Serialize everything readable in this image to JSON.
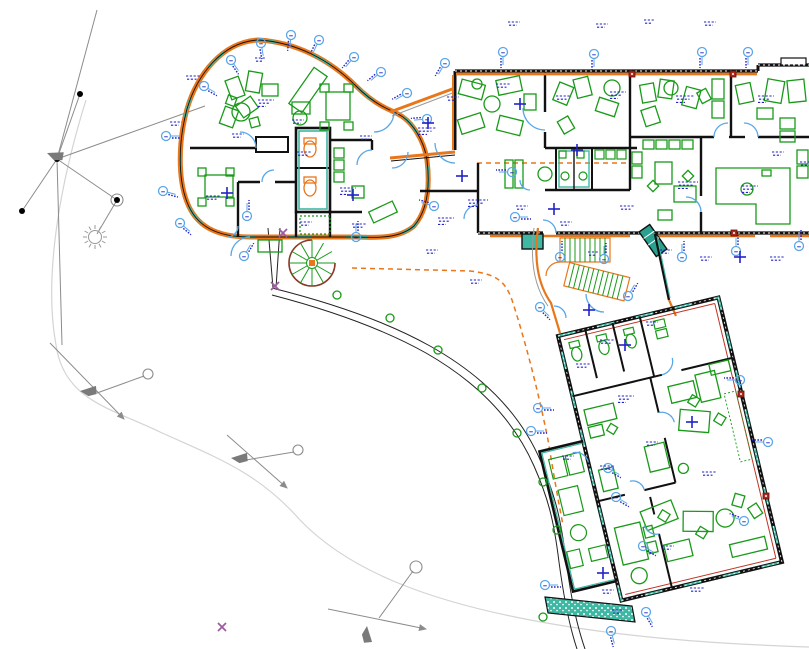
{
  "palette": {
    "wall_orange": "#E8761B",
    "wall_teal": "#3FB8A3",
    "wall_black": "#111111",
    "furniture_green": "#189A18",
    "annotation_blue": "#2323C8",
    "door_light_blue": "#5AA7E8",
    "site_gray": "#8C8C8C",
    "contour_light_gray": "#D4D4D4",
    "stair_brown": "#8B3A2A",
    "stripe_red": "#C23222",
    "marker_red": "#B3281E",
    "mark_magenta": "#A05AA0"
  },
  "annotations": {
    "tags": [
      [
        166,
        136,
        0
      ],
      [
        163,
        191,
        15
      ],
      [
        180,
        223,
        40
      ],
      [
        204,
        86,
        30
      ],
      [
        231,
        60,
        55
      ],
      [
        261,
        43,
        80
      ],
      [
        291,
        35,
        95
      ],
      [
        319,
        40,
        115
      ],
      [
        354,
        57,
        130
      ],
      [
        381,
        72,
        140
      ],
      [
        407,
        93,
        150
      ],
      [
        427,
        119,
        175
      ],
      [
        434,
        206,
        195
      ],
      [
        244,
        256,
        300
      ],
      [
        445,
        63,
        120
      ],
      [
        503,
        52,
        90
      ],
      [
        594,
        54,
        90
      ],
      [
        702,
        52,
        90
      ],
      [
        748,
        52,
        90
      ],
      [
        560,
        257,
        270
      ],
      [
        604,
        259,
        270
      ],
      [
        682,
        257,
        270
      ],
      [
        736,
        251,
        270
      ],
      [
        799,
        246,
        270
      ],
      [
        512,
        172,
        180
      ],
      [
        515,
        217,
        0
      ],
      [
        247,
        216,
        270
      ],
      [
        356,
        237,
        270
      ],
      [
        540,
        307,
        45
      ],
      [
        628,
        296,
        300
      ],
      [
        740,
        380,
        180
      ],
      [
        768,
        442,
        180
      ],
      [
        744,
        521,
        200
      ],
      [
        538,
        408,
        0
      ],
      [
        531,
        431,
        0
      ],
      [
        608,
        468,
        30
      ],
      [
        616,
        497,
        30
      ],
      [
        643,
        546,
        30
      ],
      [
        545,
        585,
        0
      ],
      [
        646,
        612,
        60
      ],
      [
        611,
        631,
        75
      ]
    ],
    "crosses": [
      [
        428,
        123
      ],
      [
        227,
        193
      ],
      [
        353,
        195
      ],
      [
        520,
        104
      ],
      [
        577,
        150
      ],
      [
        554,
        209
      ],
      [
        603,
        573
      ],
      [
        692,
        422
      ],
      [
        625,
        345
      ],
      [
        589,
        310
      ],
      [
        740,
        257
      ],
      [
        462,
        176
      ]
    ],
    "texts": [
      [
        170,
        122,
        12
      ],
      [
        186,
        76,
        14
      ],
      [
        232,
        134,
        12
      ],
      [
        258,
        100,
        16
      ],
      [
        297,
        152,
        14
      ],
      [
        206,
        196,
        14
      ],
      [
        340,
        188,
        16
      ],
      [
        352,
        224,
        14
      ],
      [
        300,
        222,
        12
      ],
      [
        418,
        128,
        18
      ],
      [
        438,
        218,
        16
      ],
      [
        468,
        200,
        20
      ],
      [
        447,
        97,
        12
      ],
      [
        496,
        84,
        14
      ],
      [
        556,
        96,
        14
      ],
      [
        610,
        92,
        16
      ],
      [
        676,
        96,
        18
      ],
      [
        758,
        96,
        16
      ],
      [
        772,
        152,
        12
      ],
      [
        800,
        162,
        12
      ],
      [
        678,
        182,
        20
      ],
      [
        742,
        186,
        16
      ],
      [
        516,
        206,
        12
      ],
      [
        560,
        222,
        12
      ],
      [
        620,
        206,
        14
      ],
      [
        588,
        252,
        10
      ],
      [
        660,
        250,
        12
      ],
      [
        700,
        257,
        12
      ],
      [
        770,
        257,
        14
      ],
      [
        508,
        22,
        12
      ],
      [
        596,
        24,
        12
      ],
      [
        644,
        20,
        10
      ],
      [
        704,
        22,
        12
      ],
      [
        600,
        340,
        14
      ],
      [
        646,
        322,
        12
      ],
      [
        576,
        364,
        14
      ],
      [
        618,
        396,
        16
      ],
      [
        562,
        456,
        12
      ],
      [
        600,
        466,
        14
      ],
      [
        646,
        442,
        12
      ],
      [
        702,
        472,
        14
      ],
      [
        662,
        546,
        12
      ],
      [
        602,
        590,
        12
      ],
      [
        690,
        588,
        14
      ],
      [
        612,
        610,
        12
      ],
      [
        426,
        250,
        12
      ],
      [
        470,
        280,
        12
      ],
      [
        360,
        136,
        12
      ],
      [
        255,
        58,
        10
      ],
      [
        292,
        120,
        12
      ]
    ],
    "path_plants": [
      [
        337,
        295
      ],
      [
        390,
        318
      ],
      [
        438,
        350
      ],
      [
        482,
        388
      ],
      [
        517,
        433
      ],
      [
        543,
        482
      ],
      [
        557,
        530
      ],
      [
        543,
        617
      ]
    ],
    "magenta_marks": [
      [
        283,
        233
      ],
      [
        275,
        286
      ],
      [
        222,
        627
      ]
    ],
    "red_markers": [
      [
        632,
        74
      ],
      [
        733,
        74
      ],
      [
        734,
        233
      ],
      [
        741,
        394
      ],
      [
        766,
        496
      ]
    ]
  },
  "site": {
    "network_lines": [
      [
        57,
        159,
        97,
        10
      ],
      [
        57,
        159,
        205,
        106
      ],
      [
        57,
        159,
        22,
        211
      ],
      [
        57,
        159,
        117,
        200
      ],
      [
        117,
        200,
        97,
        234
      ],
      [
        57,
        159,
        62,
        345
      ],
      [
        57,
        159,
        80,
        94
      ]
    ],
    "survey_points": [
      [
        80,
        94
      ],
      [
        22,
        211
      ],
      [
        117,
        200
      ],
      [
        57,
        159
      ]
    ],
    "circled_points": [
      [
        117,
        200,
        6
      ],
      [
        148,
        374,
        5
      ],
      [
        298,
        450,
        5
      ],
      [
        416,
        567,
        6
      ]
    ],
    "station_lines": [
      [
        50,
        343,
        124,
        419
      ],
      [
        227,
        435,
        287,
        488
      ],
      [
        328,
        609,
        426,
        629
      ]
    ],
    "station_links": [
      [
        97,
        393,
        144,
        376
      ],
      [
        240,
        461,
        294,
        452
      ],
      [
        379,
        618,
        413,
        571
      ]
    ],
    "flags": [
      [
        47,
        153,
        -20
      ],
      [
        80,
        391,
        -35
      ],
      [
        231,
        458,
        -35
      ],
      [
        367,
        626,
        55
      ]
    ],
    "sun": [
      95,
      237
    ]
  }
}
